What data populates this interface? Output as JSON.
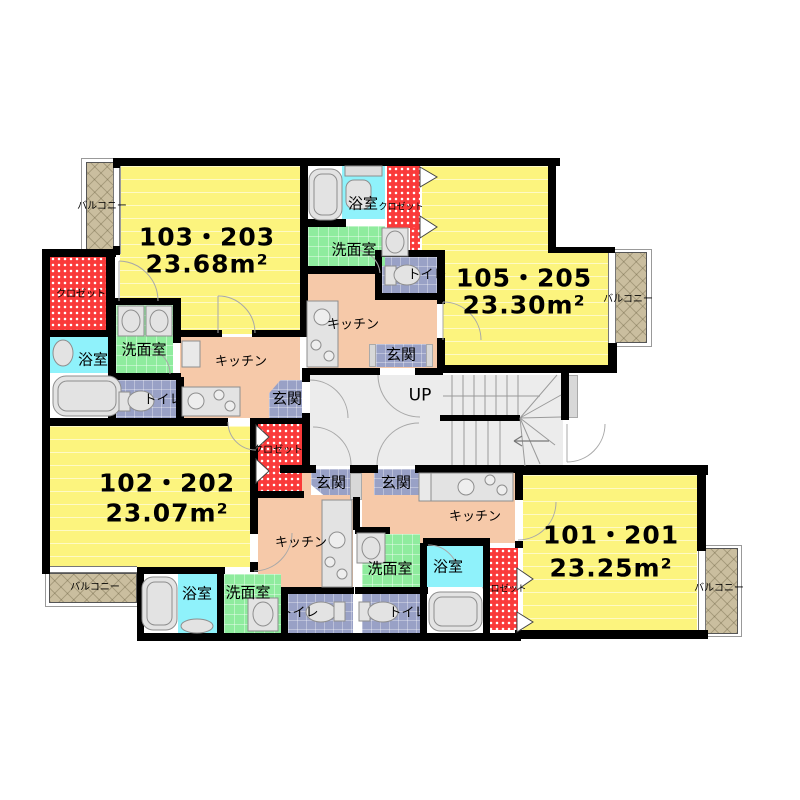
{
  "plan": {
    "units": [
      {
        "name": "103・203",
        "area": "23.68m²"
      },
      {
        "name": "105・205",
        "area": "23.30m²"
      },
      {
        "name": "102・202",
        "area": "23.07m²"
      },
      {
        "name": "101・201",
        "area": "23.25m²"
      }
    ],
    "labels": {
      "bath": "浴室",
      "washroom": "洗面室",
      "toilet": "トイレ",
      "kitchen": "キッチン",
      "entrance": "玄関",
      "closet": "クロゼット",
      "balcony": "バルコニー",
      "stairs_up": "UP"
    },
    "colors": {
      "room_yellow": "#FCF47E",
      "kitchen_peach": "#F6C9A9",
      "bath_cyan": "#8FF2FB",
      "washroom_green": "#8FEC9E",
      "tile_blue": "#99A1C6",
      "closet_red": "#FA3A3A",
      "balcony_tan": "#CABE9F",
      "hall_gray": "#ECECEC",
      "wall_black": "#000000"
    }
  }
}
